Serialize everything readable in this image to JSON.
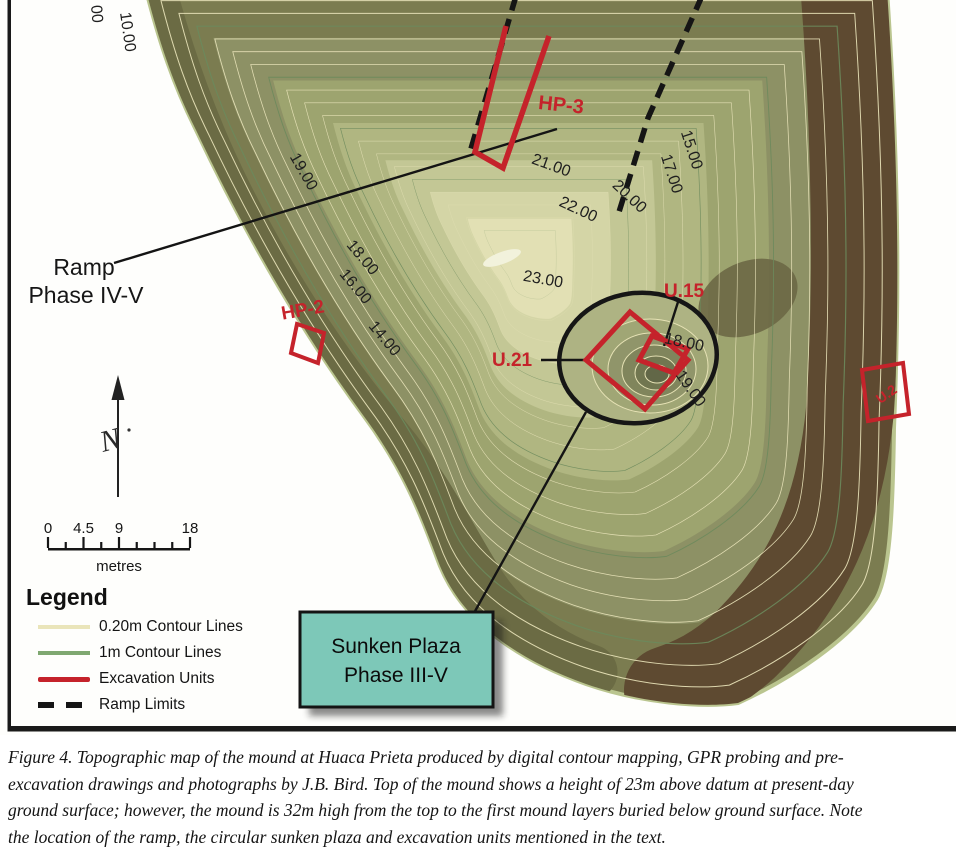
{
  "figure": {
    "caption_lines": [
      "Figure 4.  Topographic map of the mound at Huaca Prieta produced by digital contour mapping, GPR probing and pre-",
      "excavation drawings and photographs by J.B. Bird. Top of the mound shows a height of 23m above datum at present-day",
      "ground surface; however, the mound is 32m high from the top to the first mound layers buried below ground surface. Note",
      "the location of the ramp, the circular sunken plaza and excavation units mentioned in the text."
    ]
  },
  "map": {
    "ramp_label": {
      "line1": "Ramp",
      "line2": "Phase IV-V"
    },
    "plaza_box": {
      "line1": "Sunken Plaza",
      "line2": "Phase III-V",
      "fill": "#7dc8b8"
    },
    "north_label": "N",
    "scale": {
      "unit": "metres",
      "max_m": 18,
      "minor_step_m": 2.25,
      "ticks": [
        {
          "label": "0",
          "m": 0
        },
        {
          "label": "4.5",
          "m": 4.5
        },
        {
          "label": "9",
          "m": 9
        },
        {
          "label": "18",
          "m": 18
        }
      ]
    },
    "legend": {
      "title": "Legend",
      "items": [
        {
          "label": "0.20m Contour Lines",
          "swatch": "fine-contour",
          "color": "#eae5ba"
        },
        {
          "label": "1m Contour Lines",
          "swatch": "major-contour",
          "color": "#7fa871"
        },
        {
          "label": "Excavation Units",
          "swatch": "excavation-unit",
          "color": "#c5232b"
        },
        {
          "label": "Ramp Limits",
          "swatch": "ramp-limit",
          "color": "#151515"
        }
      ]
    },
    "contour_labels": [
      {
        "text": "00",
        "x": 96,
        "y": 14,
        "rot": 85
      },
      {
        "text": "10.00",
        "x": 127,
        "y": 32,
        "rot": 82
      },
      {
        "text": "19.00",
        "x": 303,
        "y": 172,
        "rot": 60
      },
      {
        "text": "18.00",
        "x": 362,
        "y": 258,
        "rot": 50
      },
      {
        "text": "16.00",
        "x": 355,
        "y": 287,
        "rot": 50
      },
      {
        "text": "14.00",
        "x": 384,
        "y": 339,
        "rot": 50
      },
      {
        "text": "21.00",
        "x": 551,
        "y": 166,
        "rot": 20
      },
      {
        "text": "22.00",
        "x": 578,
        "y": 210,
        "rot": 25
      },
      {
        "text": "20.00",
        "x": 629,
        "y": 197,
        "rot": 43
      },
      {
        "text": "15.00",
        "x": 691,
        "y": 150,
        "rot": 72
      },
      {
        "text": "17.00",
        "x": 671,
        "y": 174,
        "rot": 72
      },
      {
        "text": "23.00",
        "x": 543,
        "y": 280,
        "rot": 10
      },
      {
        "text": "18.00",
        "x": 684,
        "y": 343,
        "rot": 12
      },
      {
        "text": "19.00",
        "x": 690,
        "y": 389,
        "rot": 55
      }
    ],
    "excavation_labels": [
      {
        "text": "HP-3",
        "x": 561,
        "y": 106,
        "rot": 6,
        "size": 20
      },
      {
        "text": "HP-2",
        "x": 303,
        "y": 311,
        "rot": -10,
        "size": 19
      },
      {
        "text": "U.15",
        "x": 684,
        "y": 292,
        "rot": 0,
        "size": 19
      },
      {
        "text": "U.21",
        "x": 512,
        "y": 361,
        "rot": 0,
        "size": 19
      },
      {
        "text": "U.2",
        "x": 887,
        "y": 395,
        "rot": -35,
        "size": 14
      }
    ],
    "colors": {
      "excavation_red": "#c5232b",
      "contour_fine": "#ece7bd",
      "contour_major": "#6c8a5c",
      "plaza_outline": "#161616",
      "frame": "#1a1a1a"
    }
  }
}
